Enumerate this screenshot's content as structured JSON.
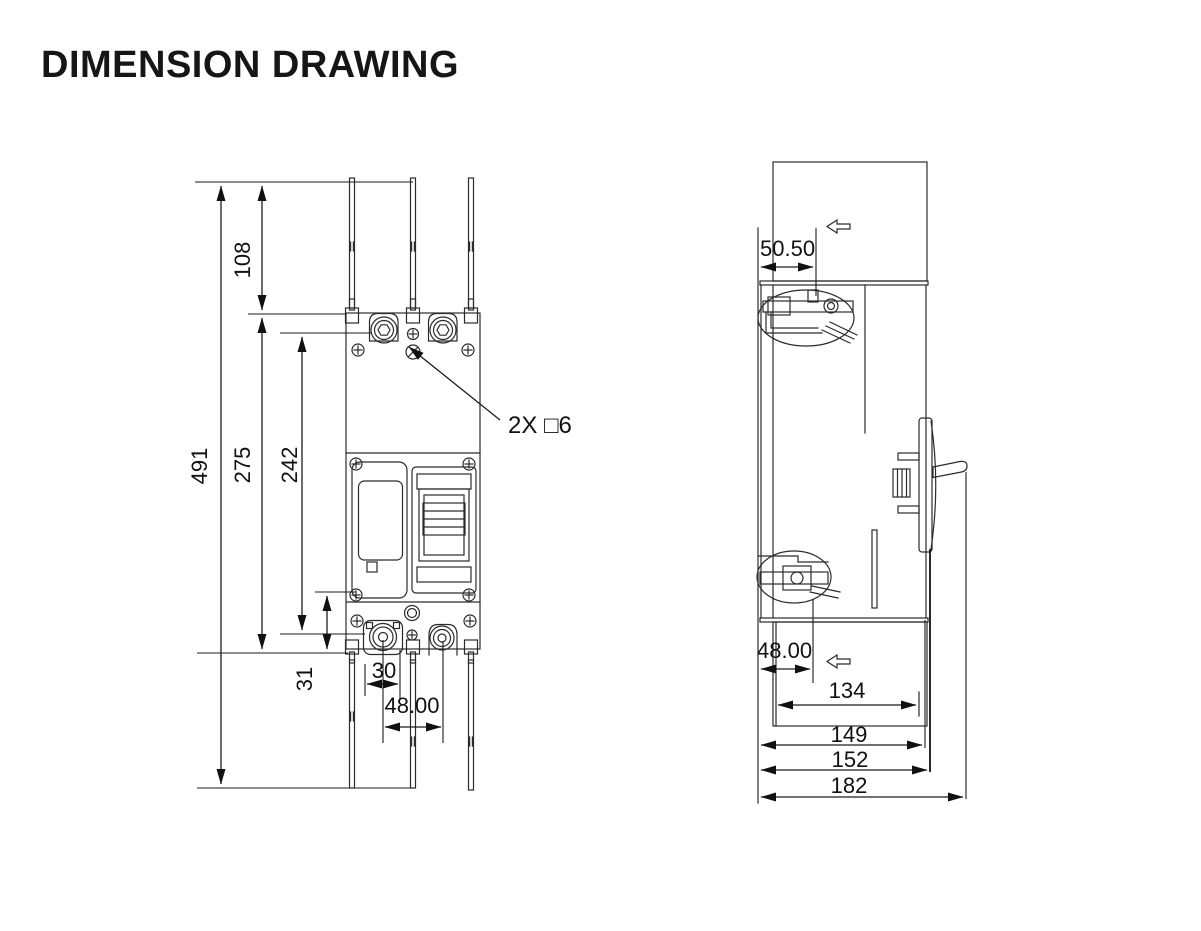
{
  "title": "DIMENSION DRAWING",
  "front_view": {
    "dimensions": {
      "overall_height": "491",
      "top_terminal_extension": "108",
      "body_height": "275",
      "terminal_centers_span": "242",
      "bottom_mount_offset": "31",
      "mount_hole_width": "30",
      "pole_pitch": "48.00"
    },
    "hole_callout": "2X □6"
  },
  "side_view": {
    "dimensions": {
      "top_terminal_depth": "50.50",
      "bottom_terminal_depth": "48.00",
      "barrier_depth": "134",
      "body_depth": "149",
      "depth_with_cover": "152",
      "overall_depth": "182"
    },
    "icons": {
      "flow_direction": "left-hollow-arrow"
    }
  }
}
